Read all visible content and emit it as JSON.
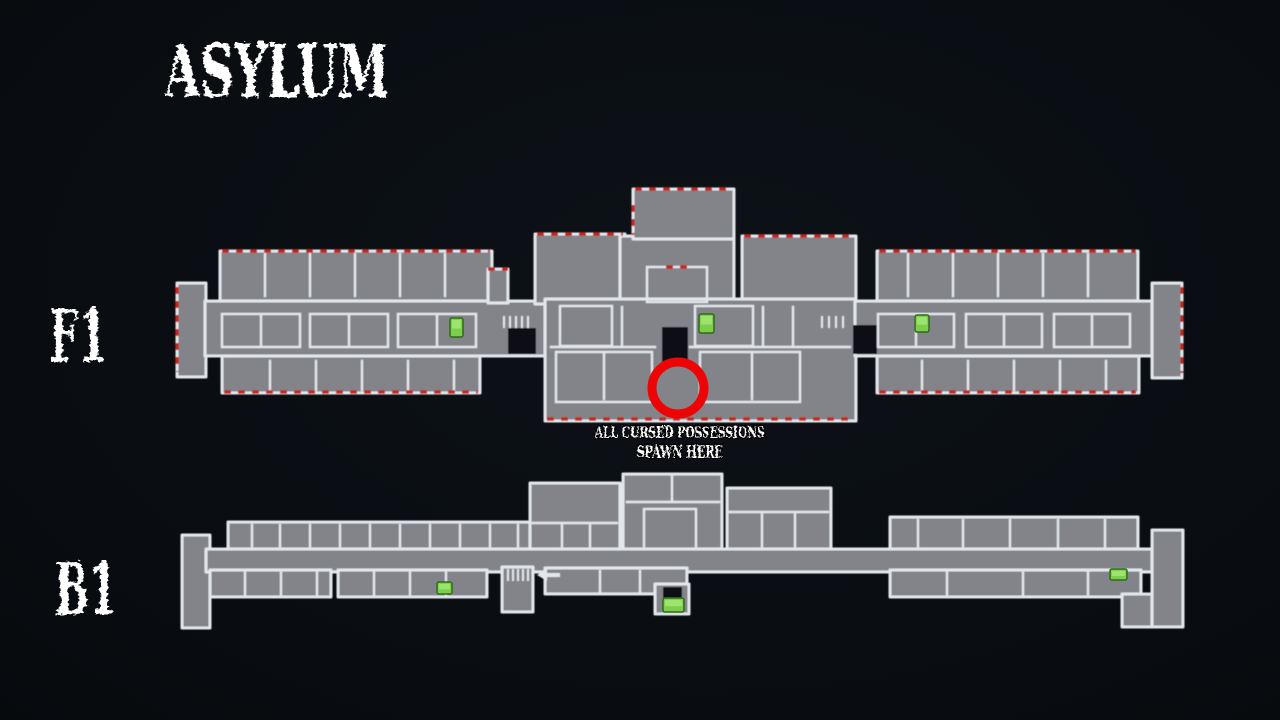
{
  "page": {
    "title": "ASYLUM",
    "background": "#0a0e13"
  },
  "floors": [
    {
      "id": "f1",
      "label": "F1"
    },
    {
      "id": "b1",
      "label": "B1"
    }
  ],
  "annotation": {
    "line1": "ALL CURSED POSSESSIONS",
    "line2": "SPAWN HERE",
    "circle": {
      "cx": 678,
      "cy": 388,
      "r": 26,
      "stroke_width": 9,
      "color": "#ee0404"
    }
  },
  "colors": {
    "background": "#0a0e13",
    "floor_fill": "#83838a",
    "wall": "#e2e7ec",
    "exterior_door_accent": "#c4281e",
    "marker_fill": "#7ccf4b",
    "marker_border": "#2f6b16",
    "circle_red": "#ee0404",
    "text": "#ffffff"
  },
  "markers": {
    "f1": [
      {
        "name": "stair-exit-marker",
        "x": 450,
        "y": 318,
        "w": 13,
        "h": 19
      },
      {
        "name": "stair-exit-marker",
        "x": 699,
        "y": 314,
        "w": 15,
        "h": 19
      },
      {
        "name": "stair-exit-marker",
        "x": 915,
        "y": 315,
        "w": 14,
        "h": 17
      }
    ],
    "b1": [
      {
        "name": "stair-exit-marker",
        "x": 437,
        "y": 582,
        "w": 15,
        "h": 12
      },
      {
        "name": "stair-exit-marker",
        "x": 663,
        "y": 598,
        "w": 21,
        "h": 14
      },
      {
        "name": "stair-exit-marker",
        "x": 1110,
        "y": 569,
        "w": 17,
        "h": 11
      }
    ]
  }
}
